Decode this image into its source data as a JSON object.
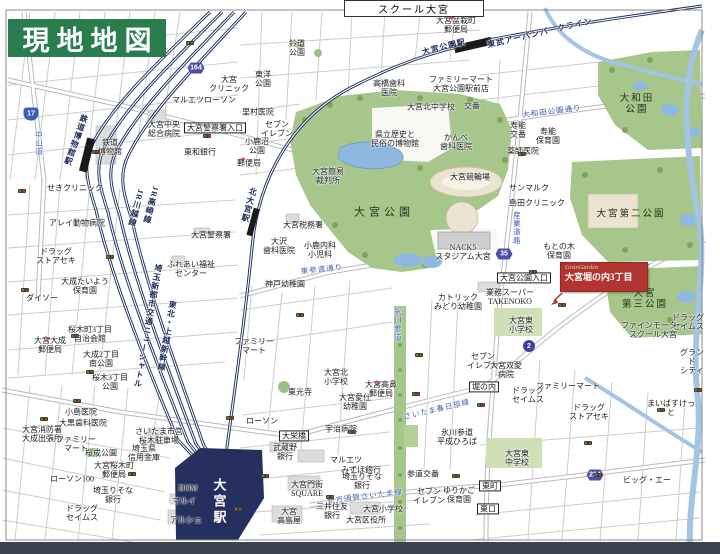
{
  "banner": {
    "title": "現地地図"
  },
  "top_box": {
    "label": "スクール大宮"
  },
  "marker": {
    "brand": "GranGarden",
    "name": "大宮堀の内3丁目"
  },
  "colors": {
    "banner_green": "#2a7d4e",
    "marker_red": "#b13431",
    "park_green": "#a6c68c",
    "water_blue": "#a3c4e4",
    "rail_navy": "#1d2c5f",
    "road_text_blue": "#3b63b8",
    "station_navy": "#25305e",
    "bottom_bar": "#3d4250"
  },
  "map": {
    "station_main": "大宮駅",
    "shields": [
      {
        "n": "17",
        "x": 31,
        "y": 114,
        "s": "nat"
      },
      {
        "n": "164",
        "x": 196,
        "y": 68,
        "s": "hex"
      },
      {
        "n": "35",
        "x": 504,
        "y": 254,
        "s": "hex"
      },
      {
        "n": "2",
        "x": 529,
        "y": 346,
        "s": "circ"
      },
      {
        "n": "214",
        "x": 595,
        "y": 475,
        "s": "hex"
      }
    ],
    "labels": [
      {
        "t": "せきクリニック",
        "x": 75,
        "y": 188,
        "c": "p"
      },
      {
        "t": "アレイ動物病院",
        "x": 77,
        "y": 223,
        "c": "p"
      },
      {
        "t": "ドラッグ\nストアセキ",
        "x": 56,
        "y": 256,
        "c": "p"
      },
      {
        "t": "大成たいよう\n保育園",
        "x": 85,
        "y": 286,
        "c": "p"
      },
      {
        "t": "ダイソー",
        "x": 42,
        "y": 298,
        "c": "p"
      },
      {
        "t": "大宮大成\n郵便局",
        "x": 50,
        "y": 345,
        "c": "p"
      },
      {
        "t": "桜木町3丁目\n自治会館",
        "x": 90,
        "y": 334,
        "c": "p"
      },
      {
        "t": "大成2丁目\n南公園",
        "x": 101,
        "y": 359,
        "c": "p"
      },
      {
        "t": "桜木3丁目\n公園",
        "x": 110,
        "y": 382,
        "c": "p"
      },
      {
        "t": "小島医院",
        "x": 81,
        "y": 412,
        "c": "p"
      },
      {
        "t": "大黒歯科医院",
        "x": 83,
        "y": 423,
        "c": "p"
      },
      {
        "t": "大宮消防署\n大成出張所",
        "x": 42,
        "y": 434,
        "c": "p"
      },
      {
        "t": "ファミリー\nマート",
        "x": 76,
        "y": 444,
        "c": "p"
      },
      {
        "t": "桜成公園",
        "x": 101,
        "y": 453,
        "c": "p"
      },
      {
        "t": "埼玉県\n信用金庫",
        "x": 144,
        "y": 453,
        "c": "p"
      },
      {
        "t": "大宮桜木町\n郵便局",
        "x": 114,
        "y": 470,
        "c": "p"
      },
      {
        "t": "ローソン100",
        "x": 72,
        "y": 479,
        "c": "p"
      },
      {
        "t": "埼玉りそな\n銀行",
        "x": 113,
        "y": 495,
        "c": "p"
      },
      {
        "t": "ドラッグ\nセイムス",
        "x": 82,
        "y": 513,
        "c": "p"
      },
      {
        "t": "さいたま市営\n桜木駐車場",
        "x": 159,
        "y": 436,
        "c": "p"
      },
      {
        "t": "DOM",
        "x": 188,
        "y": 488,
        "c": "p"
      },
      {
        "t": "マルイ",
        "x": 184,
        "y": 501,
        "c": "p"
      },
      {
        "t": "アルシェ",
        "x": 186,
        "y": 520,
        "c": "p"
      },
      {
        "t": "大宮駅",
        "x": 218,
        "y": 502,
        "c": "st",
        "v": 1
      },
      {
        "t": "大宮警察署",
        "x": 211,
        "y": 235,
        "c": "p"
      },
      {
        "t": "ふれあい福祉\nセンター",
        "x": 191,
        "y": 269,
        "c": "p"
      },
      {
        "t": "JR高崎線",
        "x": 151,
        "y": 205,
        "c": "rl",
        "v": 1,
        "r": 14
      },
      {
        "t": "JR川越線",
        "x": 136,
        "y": 208,
        "c": "rl",
        "v": 1,
        "r": 14
      },
      {
        "t": "埼玉新都市交通ニューシャトル",
        "x": 148,
        "y": 326,
        "c": "rl",
        "v": 1,
        "r": 10
      },
      {
        "t": "東北・上越新幹線",
        "x": 167,
        "y": 336,
        "c": "rl",
        "v": 1,
        "r": 10
      },
      {
        "t": "鉄道博物館駅",
        "x": 76,
        "y": 140,
        "c": "rl",
        "v": 1,
        "r": 20
      },
      {
        "t": "鉄道\n博物館",
        "x": 110,
        "y": 147,
        "c": "p"
      },
      {
        "t": "中山道",
        "x": 38,
        "y": 143,
        "c": "rd",
        "v": 1
      },
      {
        "t": "大宮中央\n総合病院",
        "x": 164,
        "y": 129,
        "c": "p"
      },
      {
        "t": "大宮警察署入口",
        "x": 215,
        "y": 128,
        "c": "bx"
      },
      {
        "t": "マルエツ",
        "x": 188,
        "y": 100,
        "c": "p"
      },
      {
        "t": "ローソン",
        "x": 220,
        "y": 100,
        "c": "p"
      },
      {
        "t": "大宮\nクリニック",
        "x": 229,
        "y": 84,
        "c": "p"
      },
      {
        "t": "東和銀行",
        "x": 200,
        "y": 152,
        "c": "p"
      },
      {
        "t": "大宮簡易\n裁判所",
        "x": 328,
        "y": 176,
        "c": "p"
      },
      {
        "t": "鈴道\n公園",
        "x": 297,
        "y": 48,
        "c": "p"
      },
      {
        "t": "東洋\n公園",
        "x": 263,
        "y": 79,
        "c": "p"
      },
      {
        "t": "大宮盆栽町\n郵便局",
        "x": 456,
        "y": 25,
        "c": "p"
      },
      {
        "t": "里村医院",
        "x": 258,
        "y": 112,
        "c": "p"
      },
      {
        "t": "セブン\nイレブン",
        "x": 277,
        "y": 129,
        "c": "p"
      },
      {
        "t": "小鹿沼\n公園",
        "x": 257,
        "y": 146,
        "c": "p"
      },
      {
        "t": "郵便局",
        "x": 249,
        "y": 163,
        "c": "p"
      },
      {
        "t": "高橋歯科\n医院",
        "x": 389,
        "y": 88,
        "c": "p"
      },
      {
        "t": "大宮北中学校",
        "x": 431,
        "y": 107,
        "c": "p"
      },
      {
        "t": "県立歴史と\n民俗の博物館",
        "x": 395,
        "y": 139,
        "c": "p"
      },
      {
        "t": "かんべ\n歯科医院",
        "x": 456,
        "y": 142,
        "c": "p"
      },
      {
        "t": "ファミリーマート\n大宮公園駅前店",
        "x": 461,
        "y": 84,
        "c": "p"
      },
      {
        "t": "大宮公園駅",
        "x": 444,
        "y": 47,
        "c": "rl",
        "r": -14
      },
      {
        "t": "東武アーバンパークライン",
        "x": 540,
        "y": 33,
        "c": "rl",
        "r": -13
      },
      {
        "t": "交番",
        "x": 472,
        "y": 106,
        "c": "p"
      },
      {
        "t": "大和田公園通り",
        "x": 552,
        "y": 112,
        "c": "rd",
        "r": -7
      },
      {
        "t": "寿能\n交番",
        "x": 518,
        "y": 130,
        "c": "p"
      },
      {
        "t": "寿能\n保育園",
        "x": 548,
        "y": 136,
        "c": "p"
      },
      {
        "t": "薬師医院",
        "x": 523,
        "y": 151,
        "c": "p"
      },
      {
        "t": "大和田\n公園",
        "x": 637,
        "y": 105,
        "c": "pk"
      },
      {
        "t": "大宮公園",
        "x": 384,
        "y": 213,
        "c": "pk2"
      },
      {
        "t": "大宮競輪場",
        "x": 470,
        "y": 177,
        "c": "p"
      },
      {
        "t": "サンマルク",
        "x": 529,
        "y": 188,
        "c": "p"
      },
      {
        "t": "島田クリニック",
        "x": 537,
        "y": 203,
        "c": "p"
      },
      {
        "t": "産業道路",
        "x": 516,
        "y": 228,
        "c": "rd",
        "v": 1
      },
      {
        "t": "NACK5\nスタジアム大宮",
        "x": 463,
        "y": 252,
        "c": "p"
      },
      {
        "t": "もとの木\n保育園",
        "x": 559,
        "y": 251,
        "c": "p"
      },
      {
        "t": "大宮公園入口",
        "x": 524,
        "y": 278,
        "c": "bx"
      },
      {
        "t": "大宮第二公園",
        "x": 631,
        "y": 215,
        "c": "pk"
      },
      {
        "t": "大宮\n第三公園",
        "x": 645,
        "y": 300,
        "c": "pk"
      },
      {
        "t": "カトリック\nみどり幼稚園",
        "x": 458,
        "y": 302,
        "c": "p"
      },
      {
        "t": "氷川参道",
        "x": 397,
        "y": 325,
        "c": "rd",
        "v": 1
      },
      {
        "t": "業務スーパー\nTAKENOKO",
        "x": 510,
        "y": 297,
        "c": "p"
      },
      {
        "t": "大宮東\n小学校",
        "x": 521,
        "y": 325,
        "c": "p"
      },
      {
        "t": "ファインモーター\nスクール大宮",
        "x": 653,
        "y": 330,
        "c": "p"
      },
      {
        "t": "グランド\nシティ",
        "x": 692,
        "y": 362,
        "c": "p"
      },
      {
        "t": "ドラッグ\nセイムス",
        "x": 688,
        "y": 322,
        "c": "p"
      },
      {
        "t": "セブン\nイレブン",
        "x": 483,
        "y": 361,
        "c": "p"
      },
      {
        "t": "大宮双愛\n病院",
        "x": 506,
        "y": 370,
        "c": "p"
      },
      {
        "t": "東光寺",
        "x": 300,
        "y": 392,
        "c": "p"
      },
      {
        "t": "大宮北\n小学校",
        "x": 336,
        "y": 377,
        "c": "p"
      },
      {
        "t": "大宮愛仕\n幼稚園",
        "x": 355,
        "y": 402,
        "c": "p"
      },
      {
        "t": "大宮高鼻\n郵便局",
        "x": 381,
        "y": 389,
        "c": "p"
      },
      {
        "t": "堀の内",
        "x": 484,
        "y": 387,
        "c": "bx"
      },
      {
        "t": "宇治病院",
        "x": 341,
        "y": 429,
        "c": "p"
      },
      {
        "t": "大栄橋",
        "x": 294,
        "y": 436,
        "c": "bx"
      },
      {
        "t": "ローソン",
        "x": 262,
        "y": 421,
        "c": "p"
      },
      {
        "t": "武蔵野\n銀行",
        "x": 285,
        "y": 452,
        "c": "p"
      },
      {
        "t": "マルエツ",
        "x": 346,
        "y": 460,
        "c": "p"
      },
      {
        "t": "みずほ銀行",
        "x": 361,
        "y": 470,
        "c": "p"
      },
      {
        "t": "埼玉りそな\n銀行",
        "x": 362,
        "y": 481,
        "c": "p"
      },
      {
        "t": "大宮門街\nSQUARE",
        "x": 307,
        "y": 489,
        "c": "p"
      },
      {
        "t": "新方須賀さいたま線",
        "x": 365,
        "y": 497,
        "c": "rd",
        "r": -7
      },
      {
        "t": "三井住友\n銀行",
        "x": 332,
        "y": 511,
        "c": "p"
      },
      {
        "t": "大宮\n高島屋",
        "x": 289,
        "y": 516,
        "c": "p"
      },
      {
        "t": "大宮小学校",
        "x": 383,
        "y": 509,
        "c": "p"
      },
      {
        "t": "大宮区役所",
        "x": 366,
        "y": 520,
        "c": "p"
      },
      {
        "t": "さいたま春日部線",
        "x": 437,
        "y": 410,
        "c": "rd",
        "r": -13
      },
      {
        "t": "氷川参道\n平成ひろば",
        "x": 457,
        "y": 437,
        "c": "p"
      },
      {
        "t": "参道交番",
        "x": 423,
        "y": 474,
        "c": "p"
      },
      {
        "t": "セブン\nイレブン",
        "x": 429,
        "y": 496,
        "c": "p"
      },
      {
        "t": "ゆりかご\n保育園",
        "x": 459,
        "y": 495,
        "c": "p"
      },
      {
        "t": "東口",
        "x": 488,
        "y": 509,
        "c": "bx"
      },
      {
        "t": "大宮東\n中学校",
        "x": 517,
        "y": 458,
        "c": "p"
      },
      {
        "t": "ドラッグ\nセイムス",
        "x": 528,
        "y": 395,
        "c": "p"
      },
      {
        "t": "ファミリーマート",
        "x": 568,
        "y": 386,
        "c": "p"
      },
      {
        "t": "ドラッグ\nストアセキ",
        "x": 589,
        "y": 412,
        "c": "p"
      },
      {
        "t": "まいばすけっと",
        "x": 671,
        "y": 408,
        "c": "p"
      },
      {
        "t": "ビッグ・エー",
        "x": 647,
        "y": 480,
        "c": "p"
      },
      {
        "t": "東町",
        "x": 490,
        "y": 486,
        "c": "bx"
      },
      {
        "t": "北大宮駅",
        "x": 249,
        "y": 205,
        "c": "rl",
        "v": 1,
        "r": 15
      },
      {
        "t": "大宮税務署",
        "x": 303,
        "y": 225,
        "c": "p"
      },
      {
        "t": "大沢\n歯科医院",
        "x": 279,
        "y": 246,
        "c": "p"
      },
      {
        "t": "小鹿内科\n小児科",
        "x": 320,
        "y": 250,
        "c": "p"
      },
      {
        "t": "東参道通り",
        "x": 322,
        "y": 270,
        "c": "rd",
        "r": -6
      },
      {
        "t": "神戸幼稚園",
        "x": 285,
        "y": 284,
        "c": "p"
      },
      {
        "t": "ファミリー\nマート",
        "x": 254,
        "y": 346,
        "c": "p"
      }
    ],
    "signals": [
      [
        27,
        31
      ],
      [
        190,
        43
      ],
      [
        115,
        53
      ],
      [
        96,
        152
      ],
      [
        207,
        136
      ],
      [
        22,
        191
      ],
      [
        110,
        257
      ],
      [
        25,
        290
      ],
      [
        75,
        336
      ],
      [
        90,
        372
      ],
      [
        77,
        401
      ],
      [
        44,
        419
      ],
      [
        132,
        474
      ],
      [
        230,
        418
      ],
      [
        265,
        476
      ],
      [
        330,
        497
      ],
      [
        416,
        394
      ],
      [
        456,
        476
      ],
      [
        522,
        154
      ],
      [
        533,
        272
      ],
      [
        562,
        305
      ],
      [
        588,
        443
      ],
      [
        598,
        475
      ],
      [
        661,
        410
      ],
      [
        698,
        390
      ],
      [
        238,
        509
      ],
      [
        352,
        432
      ],
      [
        481,
        405
      ],
      [
        419,
        355
      ],
      [
        300,
        315
      ]
    ],
    "post_offices": [
      [
        48,
        340
      ],
      [
        112,
        464
      ],
      [
        378,
        384
      ],
      [
        452,
        19
      ],
      [
        243,
        160
      ]
    ],
    "post_symbol": "〒"
  }
}
